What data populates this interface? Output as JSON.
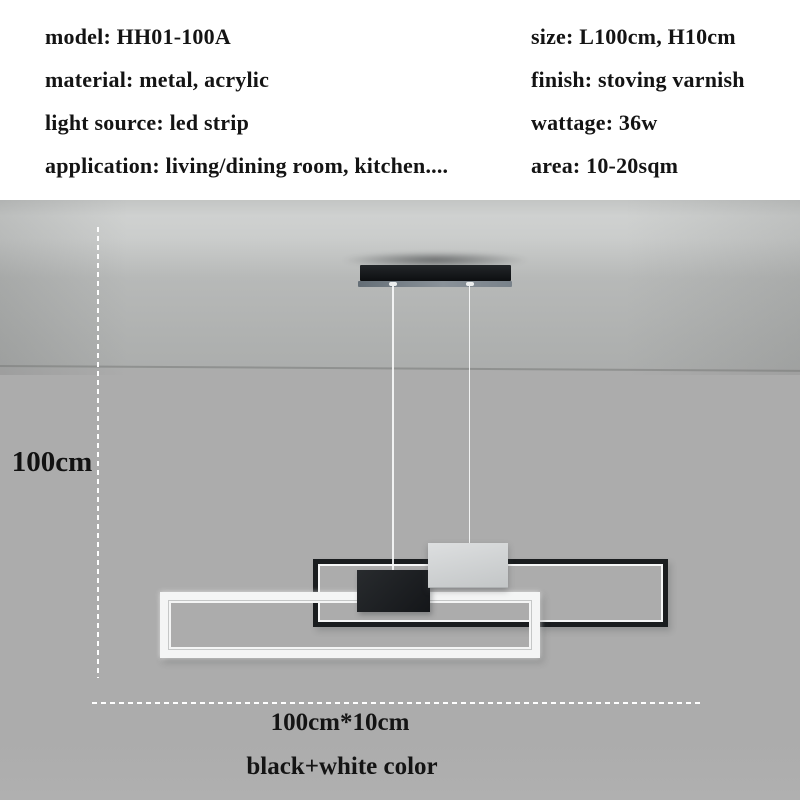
{
  "specs": {
    "left": [
      "model: HH01-100A",
      "material: metal, acrylic",
      "light source: led strip",
      "application: living/dining room, kitchen...."
    ],
    "right": [
      "size: L100cm, H10cm",
      "finish: stoving varnish",
      "wattage: 36w",
      "area: 10-20sqm"
    ]
  },
  "dimensions": {
    "height_label": "100cm",
    "size_label": "100cm*10cm",
    "color_label": "black+white color"
  },
  "colors": {
    "background_wall": "#acacac",
    "frame_black": "#1a1d1f",
    "frame_white": "#f4f5f5",
    "box_black": "#141619",
    "canopy_white": "#c3c6c7",
    "dashed_line": "#ffffff",
    "text": "#141414"
  }
}
